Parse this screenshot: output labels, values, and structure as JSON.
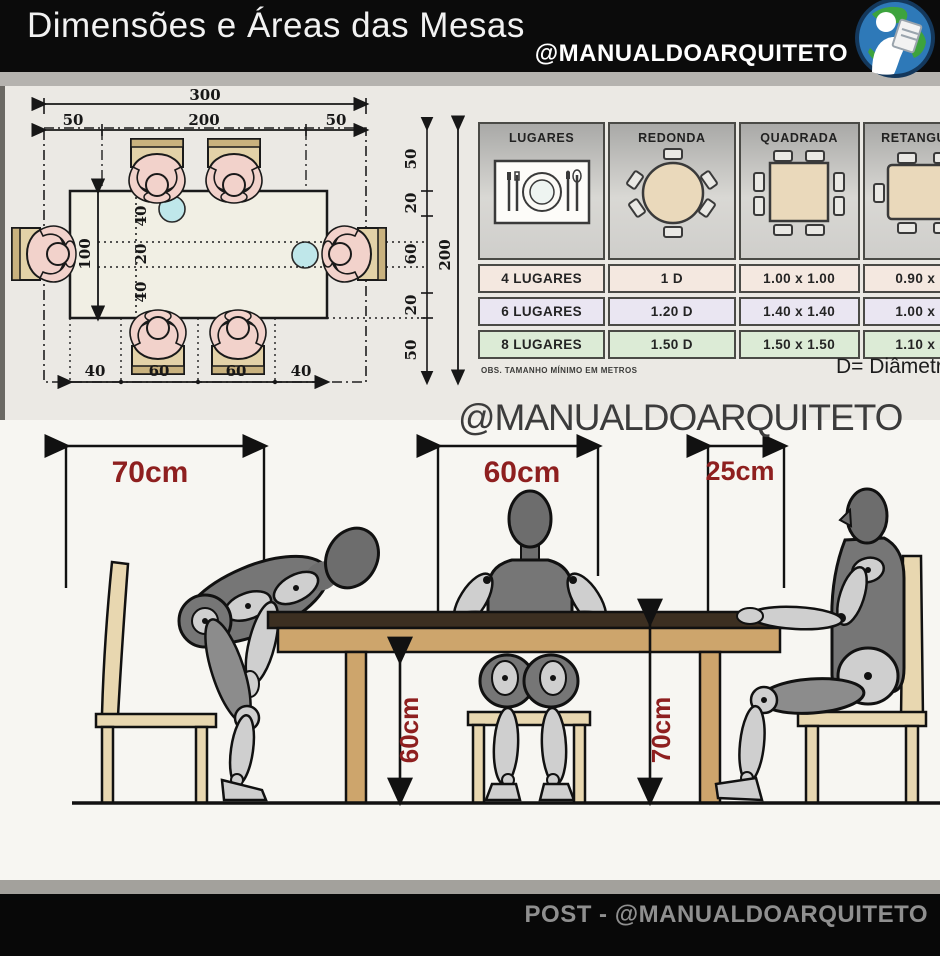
{
  "header": {
    "title": "Dimensões e Áreas das Mesas",
    "handle": "@MANUALDOARQUITETO",
    "logo": "architect-globe-logo"
  },
  "watermark": "@MANUALDOARQUITETO",
  "footer": {
    "text": "POST - @MANUALDOARQUITETO"
  },
  "floor_plan": {
    "overall_width": "300",
    "top_segments": [
      "50",
      "200",
      "50"
    ],
    "overall_depth": "200",
    "right_segments": [
      "50",
      "20",
      "60",
      "20",
      "50"
    ],
    "table_depth": "100",
    "depth_segments": [
      "40",
      "20",
      "40"
    ],
    "bottom_segments": [
      "40",
      "60",
      "60",
      "40"
    ]
  },
  "size_table": {
    "columns": [
      "LUGARES",
      "REDONDA",
      "QUADRADA",
      "RETANGULAR"
    ],
    "rows": [
      {
        "places": "4 LUGARES",
        "round": "1 D",
        "square": "1.00 x 1.00",
        "rect": "0.90 x 1.4"
      },
      {
        "places": "6 LUGARES",
        "round": "1.20 D",
        "square": "1.40 x 1.40",
        "rect": "1.00 x 1.8"
      },
      {
        "places": "8 LUGARES",
        "round": "1.50 D",
        "square": "1.50 x 1.50",
        "rect": "1.10 x 2.1"
      }
    ],
    "note": "OBS. TAMANHO MÍNIMO EM METROS",
    "legend": "D= Diâmetro",
    "row_colors": [
      "#f4e8e0",
      "#eae6f2",
      "#dcebd6"
    ]
  },
  "elevation": {
    "chair_pullback": "70cm",
    "place_width": "60cm",
    "edge_distance": "25cm",
    "knee_clearance": "60cm",
    "table_height": "70cm",
    "accent_color": "#8e1f1f"
  }
}
